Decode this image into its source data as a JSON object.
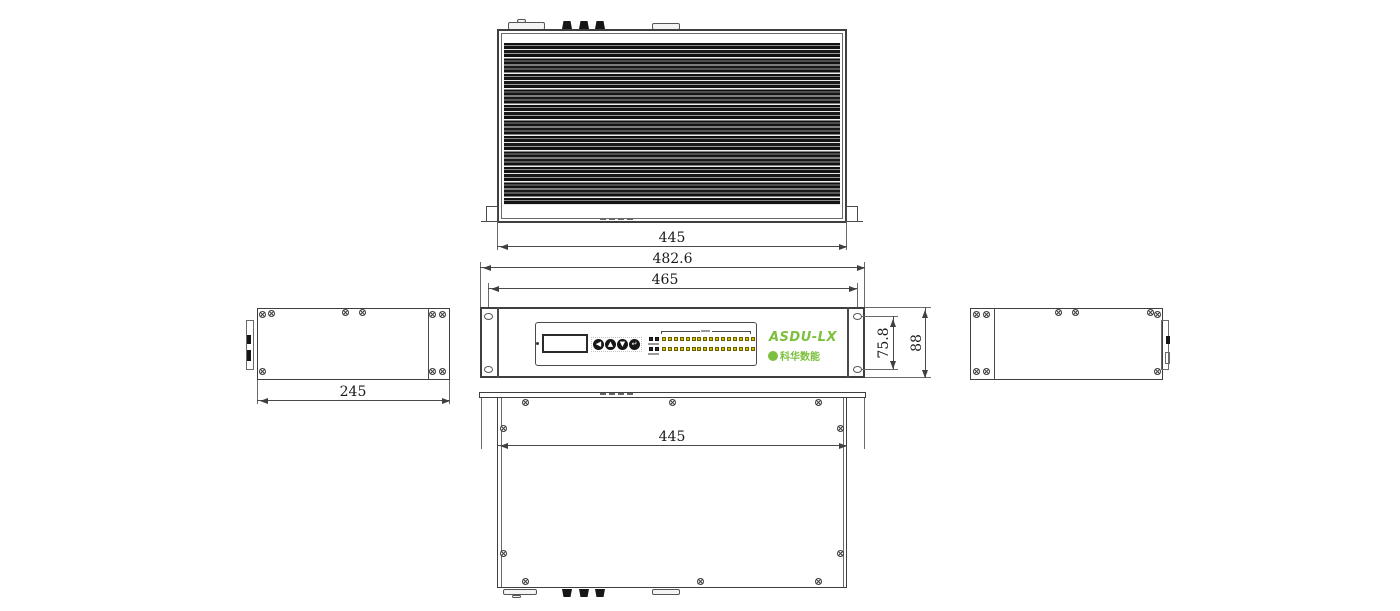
{
  "device": {
    "model": "ASDU-LX",
    "brand": "科华数能"
  },
  "views": {
    "top": {
      "dim_width": "445"
    },
    "front": {
      "dim_outer_width": "482.6",
      "dim_mount_hole_span": "465",
      "dim_inner_height": "75.8",
      "dim_outer_height": "88",
      "buttons": [
        "◀",
        "▲",
        "▼",
        "↵"
      ],
      "led_block": {
        "rows": 2,
        "leds_per_row": 16,
        "label_leds_per_row": 2
      }
    },
    "left_side": {
      "dim_depth": "245"
    },
    "right_side": {},
    "bottom": {
      "dim_width": "445"
    }
  },
  "colors": {
    "line": "#3f3f3f",
    "logo_green": "#7cc03d",
    "led_yellow": "#d6c200"
  }
}
